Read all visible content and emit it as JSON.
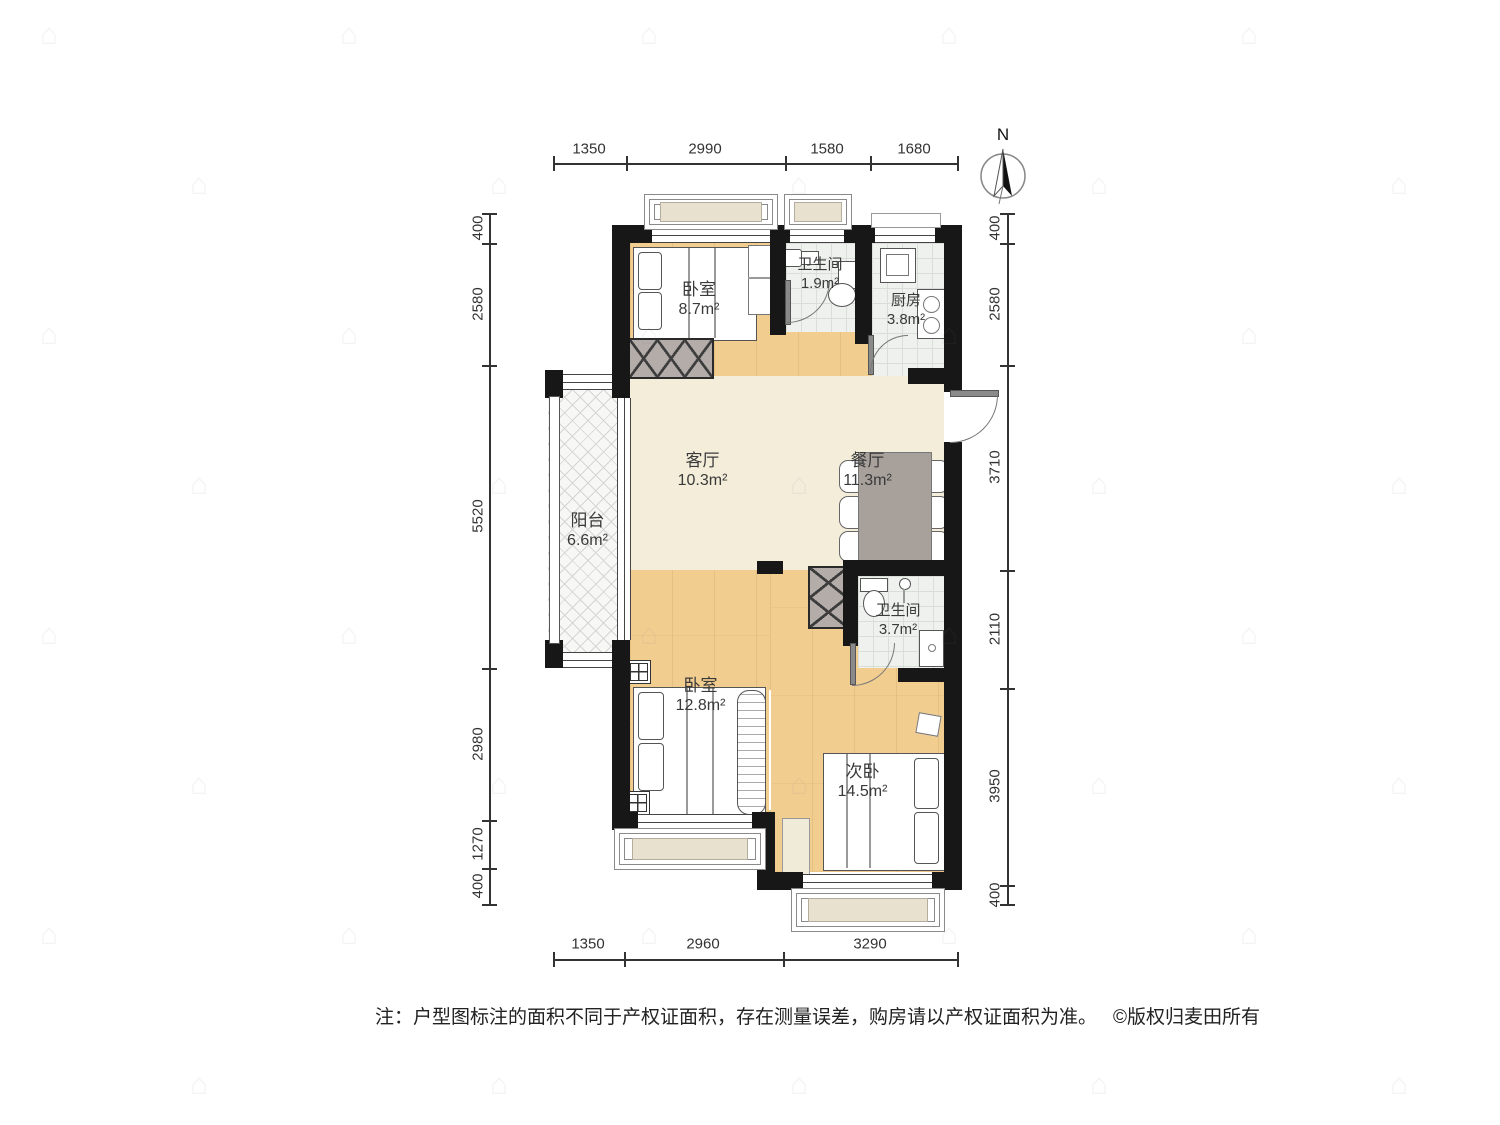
{
  "meta": {
    "width": 1500,
    "height": 1125
  },
  "compass": {
    "label": "N"
  },
  "rooms": [
    {
      "id": "bedroom1",
      "name": "卧室",
      "area": "8.7m²"
    },
    {
      "id": "bath1",
      "name": "卫生间",
      "area": "1.9m²"
    },
    {
      "id": "kitchen",
      "name": "厨房",
      "area": "3.8m²"
    },
    {
      "id": "living",
      "name": "客厅",
      "area": "10.3m²"
    },
    {
      "id": "dining",
      "name": "餐厅",
      "area": "11.3m²"
    },
    {
      "id": "balcony",
      "name": "阳台",
      "area": "6.6m²"
    },
    {
      "id": "bath2",
      "name": "卫生间",
      "area": "3.7m²"
    },
    {
      "id": "bedroom2",
      "name": "卧室",
      "area": "12.8m²"
    },
    {
      "id": "bedroom3",
      "name": "次卧",
      "area": "14.5m²"
    }
  ],
  "dimensions": {
    "top": [
      "1350",
      "2990",
      "1580",
      "1680"
    ],
    "bottom": [
      "1350",
      "2960",
      "3290"
    ],
    "left": [
      "400",
      "2580",
      "5520",
      "2980",
      "1270",
      "400"
    ],
    "right": [
      "400",
      "2580",
      "3710",
      "2110",
      "3950",
      "400"
    ]
  },
  "note": {
    "text": "注：户型图标注的面积不同于产权证面积，存在测量误差，购房请以产权证面积为准。",
    "copyright": "©版权归麦田所有"
  },
  "watermark": {
    "glyph": "⌂"
  }
}
